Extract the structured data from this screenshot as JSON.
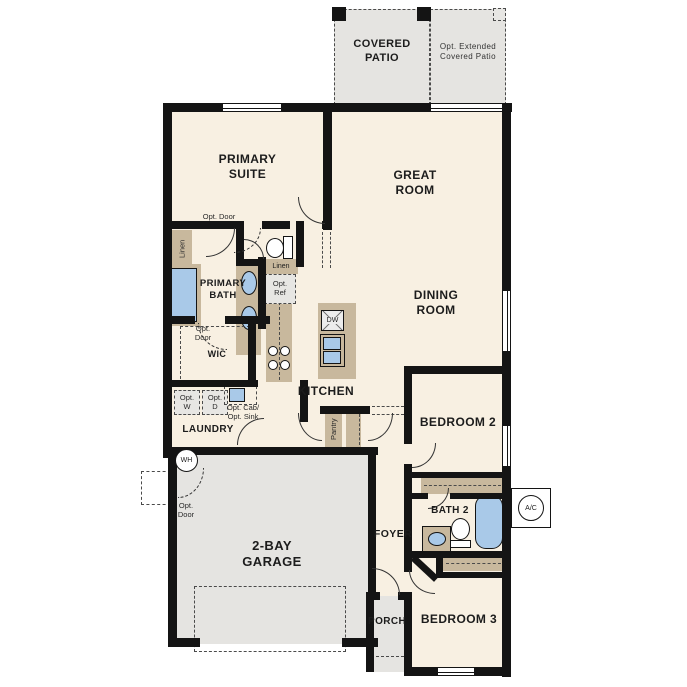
{
  "palette": {
    "wall": "#141414",
    "room_fill": "#f8f0e2",
    "outdoor_fill": "#e5e4e1",
    "cabinet_tan": "#c8b89d",
    "fixture_blue": "#a9c9e8"
  },
  "rooms": {
    "covered_patio": "COVERED\nPATIO",
    "opt_extended_patio": "Opt. Extended\nCovered Patio",
    "primary_suite": "PRIMARY\nSUITE",
    "great_room": "GREAT\nROOM",
    "dining_room": "DINING\nROOM",
    "primary_bath": "PRIMARY\nBATH",
    "wic": "WIC",
    "kitchen": "KITCHEN",
    "laundry": "LAUNDRY",
    "bedroom2": "BEDROOM 2",
    "bath2": "BATH 2",
    "foyer": "FOYER",
    "garage": "2-BAY\nGARAGE",
    "porch": "PORCH",
    "bedroom3": "BEDROOM 3"
  },
  "labels": {
    "linen_closet": "Linen",
    "linen_hall": "Linen",
    "opt_door_suite": "Opt. Door",
    "opt_door_wic": "Opt.\nDoor",
    "opt_door_garage": "Opt.\nDoor",
    "opt_ref": "Opt.\nRef",
    "opt_washer": "Opt.\nW",
    "opt_dryer": "Opt.\nD",
    "opt_cab_sink": "Opt. Cab/\nOpt. Sink",
    "pantry": "Pantry",
    "dishwasher": "DW",
    "water_heater": "WH",
    "ac_unit": "A/C"
  }
}
